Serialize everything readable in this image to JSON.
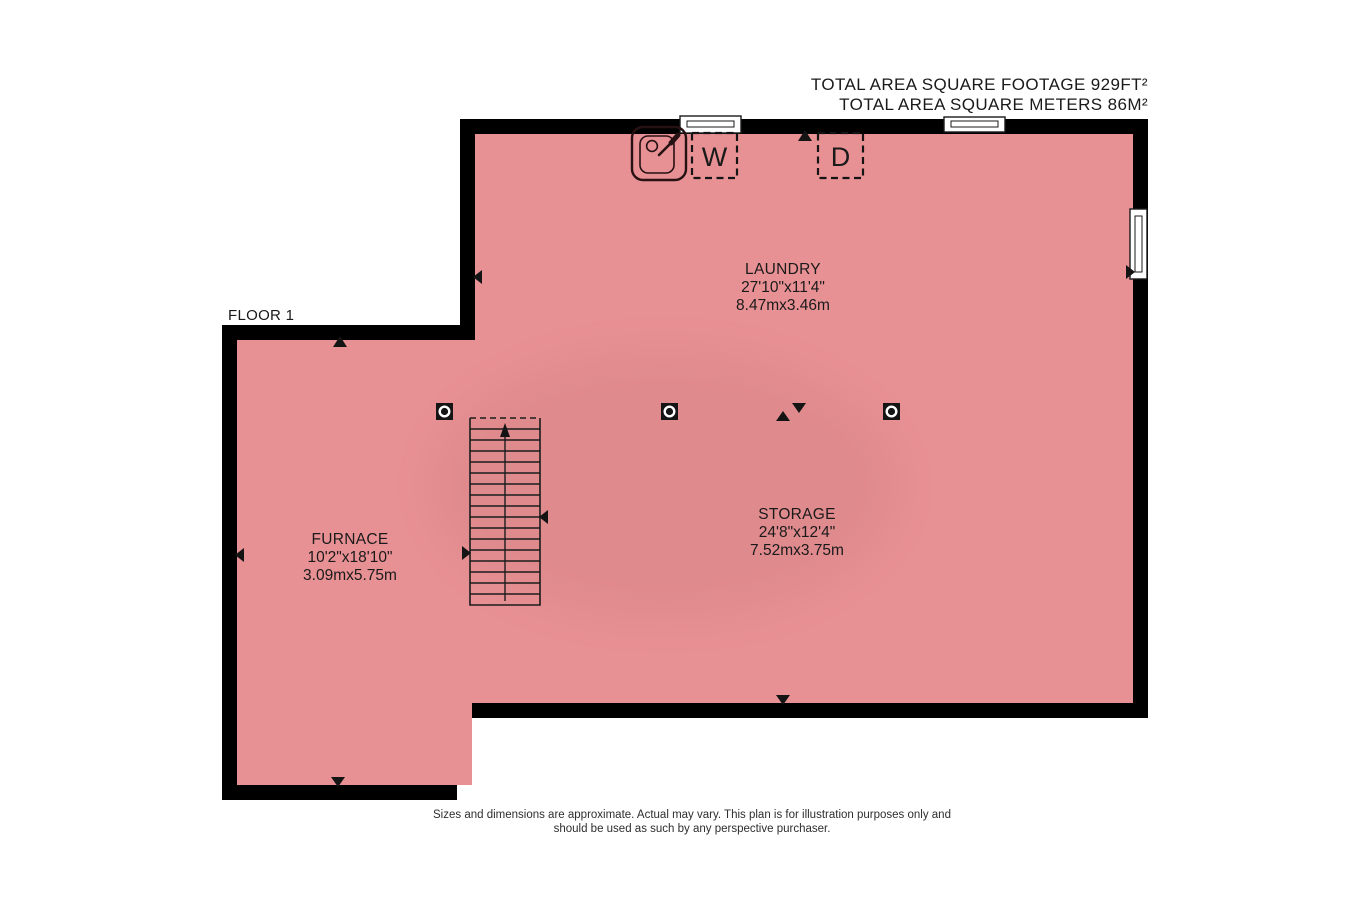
{
  "colors": {
    "floor": "#e89194",
    "wall": "#000000",
    "accent_text": "#1a1a1a"
  },
  "header": {
    "line1": "TOTAL AREA SQUARE FOOTAGE 929FT²",
    "line2": "TOTAL AREA SQUARE METERS 86M²"
  },
  "floor_label": "FLOOR 1",
  "rooms": {
    "laundry": {
      "name": "LAUNDRY",
      "imperial": "27'10\"x11'4\"",
      "metric": "8.47mx3.46m"
    },
    "storage": {
      "name": "STORAGE",
      "imperial": "24'8\"x12'4\"",
      "metric": "7.52mx3.75m"
    },
    "furnace": {
      "name": "FURNACE",
      "imperial": "10'2\"x18'10\"",
      "metric": "3.09mx5.75m"
    }
  },
  "appliances": {
    "washer_label": "W",
    "dryer_label": "D"
  },
  "disclaimer": {
    "line1": "Sizes and dimensions are approximate. Actual may vary. This plan is for illustration purposes only and",
    "line2": "should be used as such by any perspective purchaser."
  }
}
